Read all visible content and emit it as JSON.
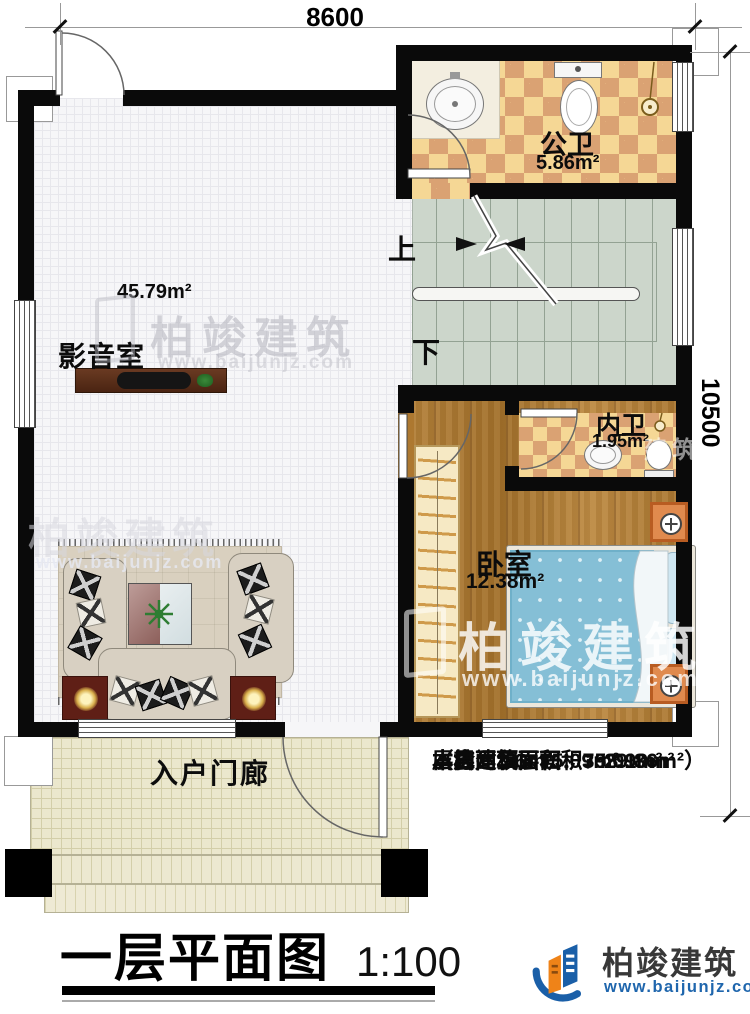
{
  "dims": {
    "width": "8600",
    "height": "10500"
  },
  "rooms": {
    "public_bath": {
      "label": "公卫",
      "area": "5.86m²"
    },
    "media": {
      "label": "影音室",
      "area": "45.79m²"
    },
    "private_bath": {
      "label": "内卫",
      "area": "1.95m²"
    },
    "bedroom": {
      "label": "卧室",
      "area": "12.38m²"
    },
    "porch": {
      "label": "入户门廊"
    }
  },
  "stairs": {
    "up": "上",
    "down": "下"
  },
  "info": {
    "floor_area": "本层建筑面积：75.09m²",
    "building_area": "本栋建筑面积：393.19m²",
    "attic_area": "（含闷顶层面积：29.86m²）",
    "land_area": "占地面积：75.09m²",
    "storey_height": "层高：3.6m"
  },
  "title": {
    "text": "一层平面图",
    "scale": "1:100"
  },
  "brand": {
    "name": "柏竣建筑",
    "url": "www.baijunjz.com",
    "partial": "建筑"
  }
}
